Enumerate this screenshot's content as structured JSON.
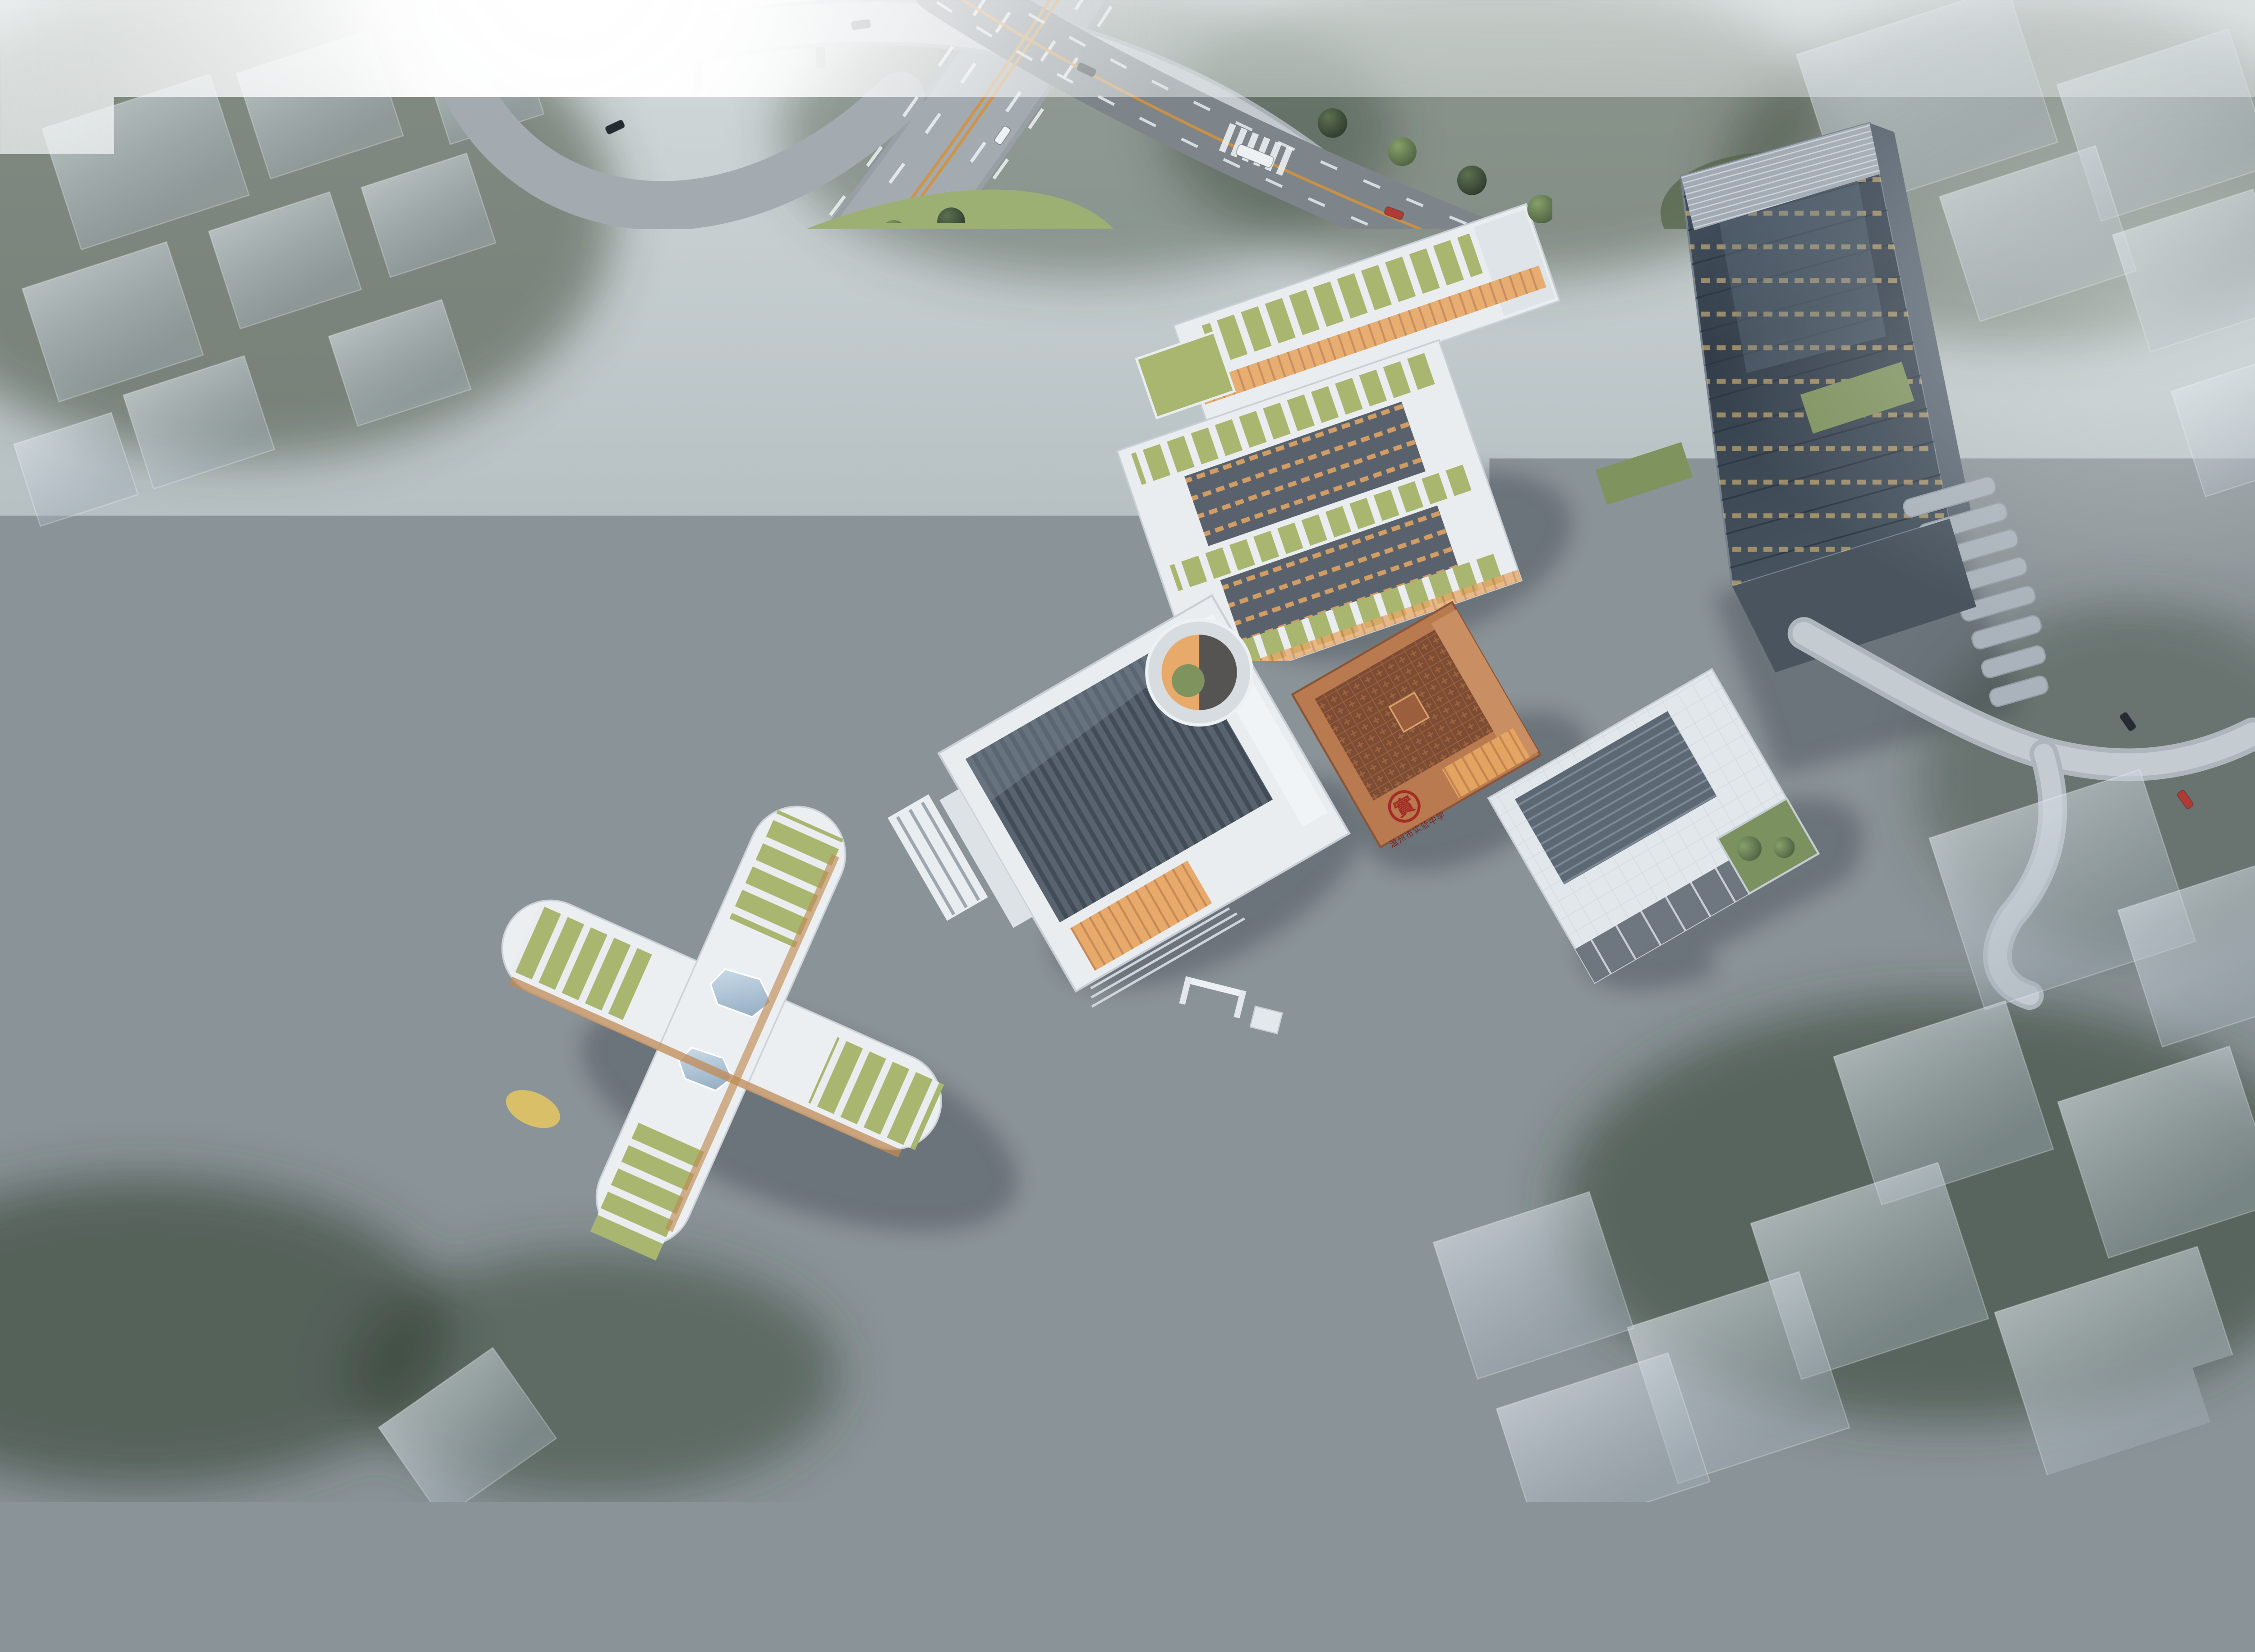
{
  "scene": {
    "title": "Aerial architectural rendering — school campus masterplan in morning fog",
    "setting": "bird's-eye perspective, sun glare from the upper left, elevated highway interchange on the left, surrounding city shown as translucent massing blocks in mist",
    "site_elements": [
      "elevated-highway",
      "interchange-ramp",
      "elevated-viaduct",
      "north-arterial-road",
      "running-track-with-football-pitch",
      "sprint-lanes-strip",
      "basketball-court-cluster",
      "single-basketball-court",
      "tennis-court-red-oval",
      "blue-jogging-loop",
      "northwest-park-lawn",
      "classroom-courtyard-block",
      "north-teaching-slab",
      "auditorium-gymnasium",
      "copper-cultural-hall",
      "library-office-block",
      "x-shaped-kindergarten",
      "high-rise-tower-with-terraces",
      "tower-podium-steps",
      "sunken-circular-courtyard",
      "entry-plaza",
      "campus-gate",
      "pond-with-fountains",
      "water-pavilion",
      "skybridge",
      "south-woodland-hill",
      "ghost-city-blocks",
      "fog"
    ]
  },
  "school": {
    "emblem_character": "實",
    "name": "温州市实验中学"
  },
  "colors": {
    "skyTop": "#d3dadb",
    "skyMid": "#b6c0c2",
    "skyLow": "#9ba5a7",
    "skyBot": "#878f93",
    "sun": "#ffffff",
    "fog": "#eef2f2",
    "forest": "#3f4d3d",
    "forestDark": "#313f31",
    "lawnBright": "#9cb074",
    "lawnMid": "#7c9161",
    "lawnDark": "#55664a",
    "treeGreen": "#86a06a",
    "treeGreenDark": "#4c5f41",
    "treeDeep": "#2d392d",
    "treeYellow": "#d8cf74",
    "treeYellowDark": "#958d45",
    "roadLight": "#a4abb0",
    "roadMid": "#7d848a",
    "roadDark": "#4f565c",
    "laneWhite": "#eef1f3",
    "laneOrange": "#d2913f",
    "trackBlue": "#4e7fae",
    "trackLight": "#6f94bd",
    "pitchGreen": "#93ab74",
    "courtGreen": "#78a287",
    "courtBlue": "#54789f",
    "courtRed": "#9c5f63",
    "bldgWhite": "#e9edf0",
    "bldgEdge": "#c9cfd6",
    "roofGreen": "#a9b66f",
    "facadeDark": "#59626c",
    "windowWarm": "#e8a763",
    "roofDark": "#58636f",
    "ridgeDark": "#414c57",
    "copper": "#b97a50",
    "copperDark": "#8a5538",
    "copperRoof": "#7d4c34",
    "copperLight": "#c98f63",
    "sealRed": "#a32c25",
    "towerHi": "#4b5866",
    "towerMid": "#333e4a",
    "towerLo": "#46535f",
    "towerFrame": "#76818d",
    "towerSide": "#5b6672",
    "louver": "#a2abb4",
    "terrace": "#aab3bb",
    "podium": "#87909a",
    "paving": "#b5bcc2",
    "plaza": "#c6ccd2",
    "plazaStripe": "#d4dae0",
    "ghostHi": "#dae2e8",
    "ghostLo": "#a4b0ba",
    "water": "#6e93ad",
    "glassHi": "#cfe0ec",
    "glassLo": "#8fa8bf",
    "carWhite": "#eef1f3",
    "carBlack": "#262c33",
    "carGray": "#3c434b",
    "carRed": "#b23a35",
    "carOrange": "#c07a3e",
    "carSilver": "#c3c9ce",
    "busBlue": "#a9cdd9",
    "people": "#22272d",
    "shadow": "#2a333c"
  }
}
